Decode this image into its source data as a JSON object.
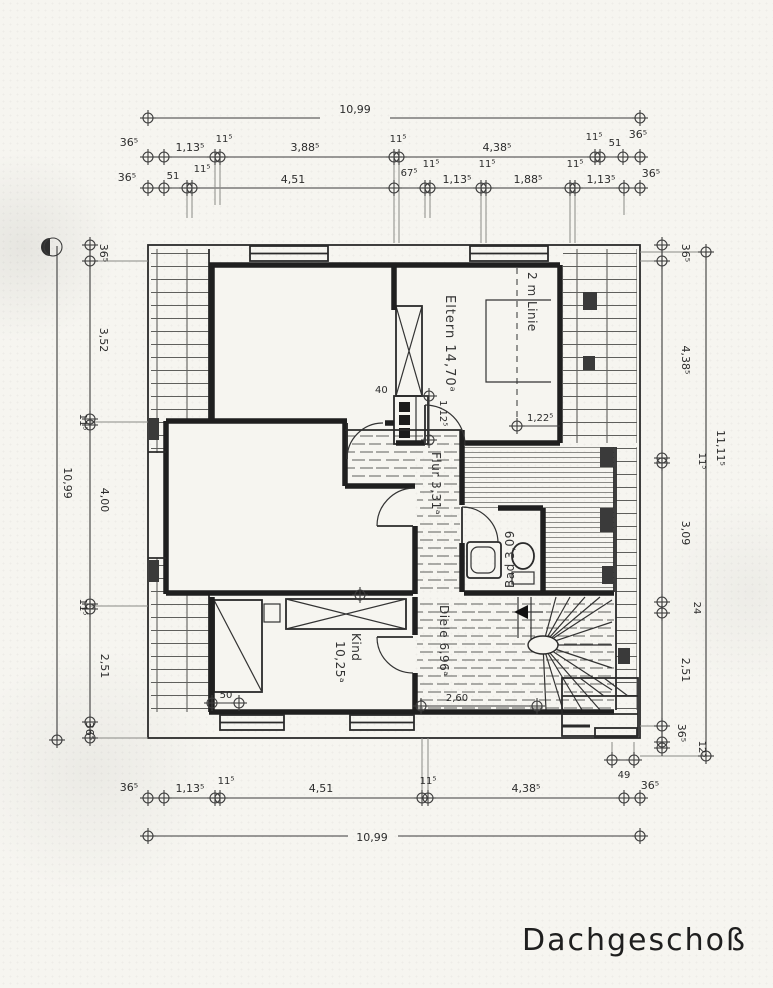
{
  "title": "Dachgeschoß",
  "rooms": {
    "eltern": "Eltern 14,70ᵃ",
    "two_m_line": "2 m Linie",
    "flur": "Flur 3,31ᵃ",
    "bad": "Bad 3,09",
    "diele": "Diele 6,96ᵃ",
    "kind_name": "Kind",
    "kind_area": "10,25ᵃ"
  },
  "dims": {
    "overall_width_top": "10,99",
    "overall_width_bottom": "10,99",
    "overall_height_left": "10,99",
    "overall_height_right": "11,11⁵",
    "top_row1": [
      "36⁵",
      "1,13⁵",
      "11⁵",
      "3,88⁵",
      "11⁵",
      "4,38⁵",
      "11⁵",
      "51",
      "36⁵"
    ],
    "top_row2": [
      "36⁵",
      "51",
      "11⁵",
      "4,51",
      "67⁵",
      "11⁵",
      "1,13⁵",
      "11⁵",
      "1,88⁵",
      "11⁵",
      "1,13⁵",
      "36⁵"
    ],
    "bottom_row": [
      "36⁵",
      "1,13⁵",
      "11⁵",
      "4,51",
      "11⁵",
      "4,38⁵",
      "36⁵"
    ],
    "dim_49": "49",
    "left_chain": [
      "36⁵",
      "3,52",
      "11⁵",
      "4,00",
      "11⁵",
      "2,51",
      "36⁵"
    ],
    "right_chain": [
      "36⁵",
      "4,38⁵",
      "11⁵",
      "3,09",
      "24",
      "2,51",
      "36⁵",
      "12⁵"
    ],
    "stack_width": "40",
    "door_112": "1,12⁵",
    "line_122": "1,22⁵",
    "bed_50": "50",
    "diele_260": "2,60"
  }
}
